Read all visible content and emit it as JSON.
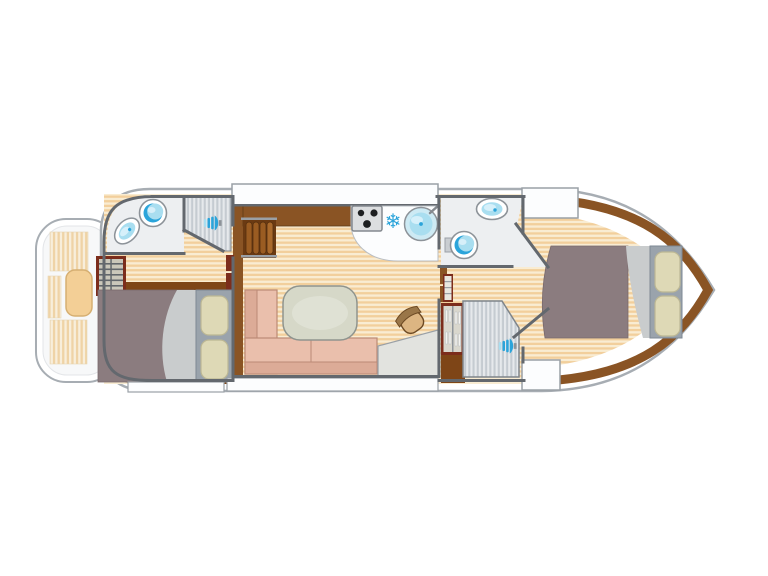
{
  "icons": {
    "freezer_glyph": "❄",
    "shower_head": "blue-spray-nozzle",
    "toilet": "round-bowl",
    "sink": "oval-basin",
    "stove": "three-burner-hob"
  },
  "colors": {
    "hull-stroke": "#a7adb3",
    "panel": "#fcfdfe",
    "panel-stroke": "#9aa0a6",
    "wall": "#63686e",
    "floor-light": "#f9ecd2",
    "floor-dark": "#f2cf9c",
    "deck-light": "#f8eedb",
    "deck-dark": "#efd3a6",
    "shower-light": "#e6e9ec",
    "shower-dark": "#c5cbd1",
    "wood": "#8a5424",
    "wood-dark": "#7e4517",
    "wood-red": "#7c2d1c",
    "bath-floor": "#edeff1",
    "fixture-blue": "#a9def0",
    "fixture-blue-dark": "#2ba4da",
    "fixture-stroke": "#8d9399",
    "bed-blanket": "#8b7c7f",
    "bed-sheet": "#c9cccd",
    "headboard": "#9aa3ac",
    "pillow": "#ded9b6",
    "pillow-stroke": "#bcb794",
    "sofa": "#eabfac",
    "sofa-dark": "#dcab97",
    "sofa-stroke": "#bb8a76",
    "table": "#d6d8c8",
    "table-stroke": "#8f948e",
    "seat-tan": "#f3cf96",
    "seat-tan-stroke": "#d6af72",
    "stool": "#dcb582",
    "stool-dark": "#9a7648",
    "stove": "#dcdee0",
    "stove-stroke": "#84898f",
    "burner": "#1d1f21",
    "steps-base": "#6b3a12",
    "steps-tread": "#9a5c22",
    "snowflake": "#2ba4da"
  }
}
